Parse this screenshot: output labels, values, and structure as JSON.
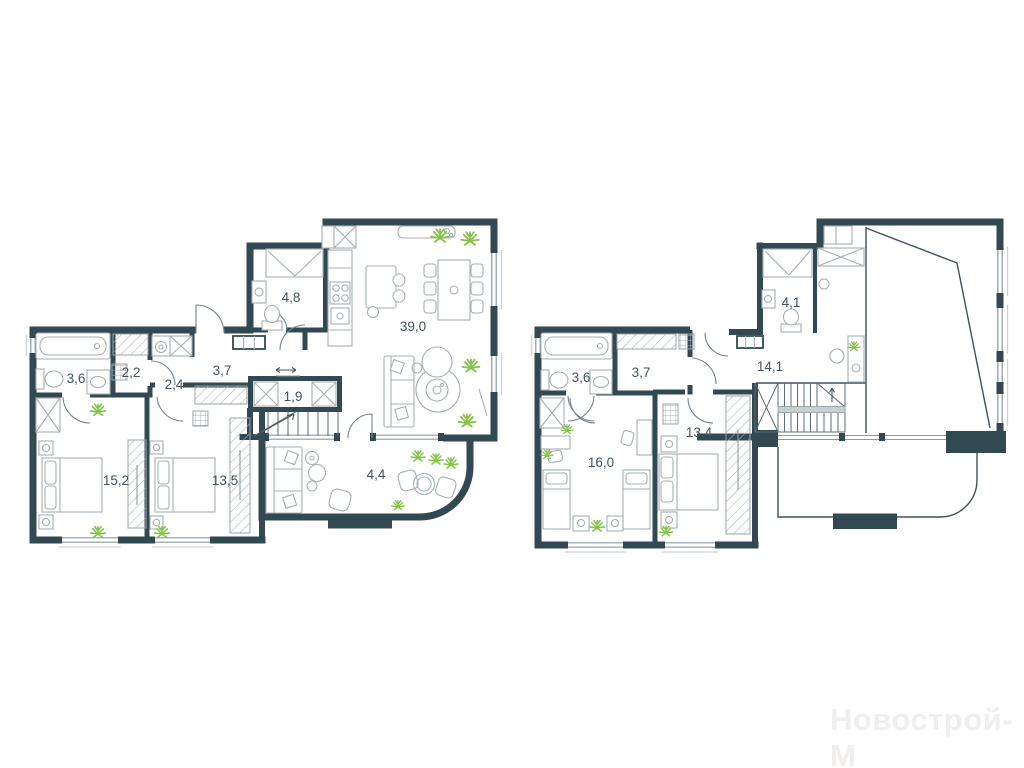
{
  "watermark": "Новострой-М",
  "palette": {
    "wall": "#334952",
    "furniture": "#a6b0b5",
    "plant": "#85c24a",
    "label": "#44535b",
    "watermark_color": "#f1eeee"
  },
  "floor1": {
    "rooms": [
      {
        "id": "bathroom",
        "area": "3,6"
      },
      {
        "id": "closet",
        "area": "2,2"
      },
      {
        "id": "hall-small",
        "area": "2,4"
      },
      {
        "id": "corridor",
        "area": "3,7"
      },
      {
        "id": "shower-room",
        "area": "4,8"
      },
      {
        "id": "kitchen-living-room",
        "area": "39,0"
      },
      {
        "id": "storage",
        "area": "1,9"
      },
      {
        "id": "bedroom-1",
        "area": "15,2"
      },
      {
        "id": "bedroom-2",
        "area": "13,5"
      },
      {
        "id": "balcony",
        "area": "4,4"
      }
    ]
  },
  "floor2": {
    "rooms": [
      {
        "id": "bathroom",
        "area": "3,6"
      },
      {
        "id": "corridor",
        "area": "3,7"
      },
      {
        "id": "shower-room",
        "area": "4,1"
      },
      {
        "id": "hall",
        "area": "14,1"
      },
      {
        "id": "bedroom-3",
        "area": "16,0"
      },
      {
        "id": "bedroom-4",
        "area": "13,4"
      }
    ]
  }
}
